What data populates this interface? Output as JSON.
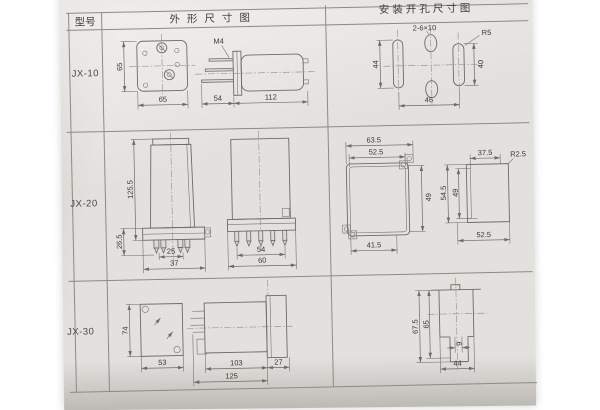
{
  "document": {
    "headers": {
      "model": "型号",
      "outline": "外形尺寸图",
      "mounting": "安装开孔尺寸图"
    }
  },
  "rows": [
    {
      "model": "JX-10",
      "outline": {
        "front_h": "65",
        "front_w": "65",
        "thread": "M4",
        "pin_len": "54",
        "body_len": "112"
      },
      "mounting": {
        "holes": "2-6×10",
        "radius": "R5",
        "left_h": "44",
        "right_h": "40",
        "width": "46"
      }
    },
    {
      "model": "JX-20",
      "outline": {
        "height": "125.5",
        "base_h": "26.5",
        "pin_span": "25",
        "flange_w": "37",
        "side_pin_span": "54",
        "side_w": "60"
      },
      "mounting": {
        "f1_outer_w": "63.5",
        "f1_inner_w": "52.5",
        "f1_h": "49",
        "f1_bottom_w": "41.5",
        "f2_top_w": "37.5",
        "f2_radius": "R2.5",
        "f2_outer_h": "54.5",
        "f2_inner_h": "49",
        "f2_bottom_w": "52.5"
      }
    },
    {
      "model": "JX-30",
      "outline": {
        "front_h": "74",
        "front_w": "53",
        "body_len": "103",
        "rear_len": "27",
        "total_len": "125"
      },
      "mounting": {
        "outer_h": "67.5",
        "inner_h": "65",
        "notch_w": "9",
        "width": "44"
      }
    }
  ]
}
